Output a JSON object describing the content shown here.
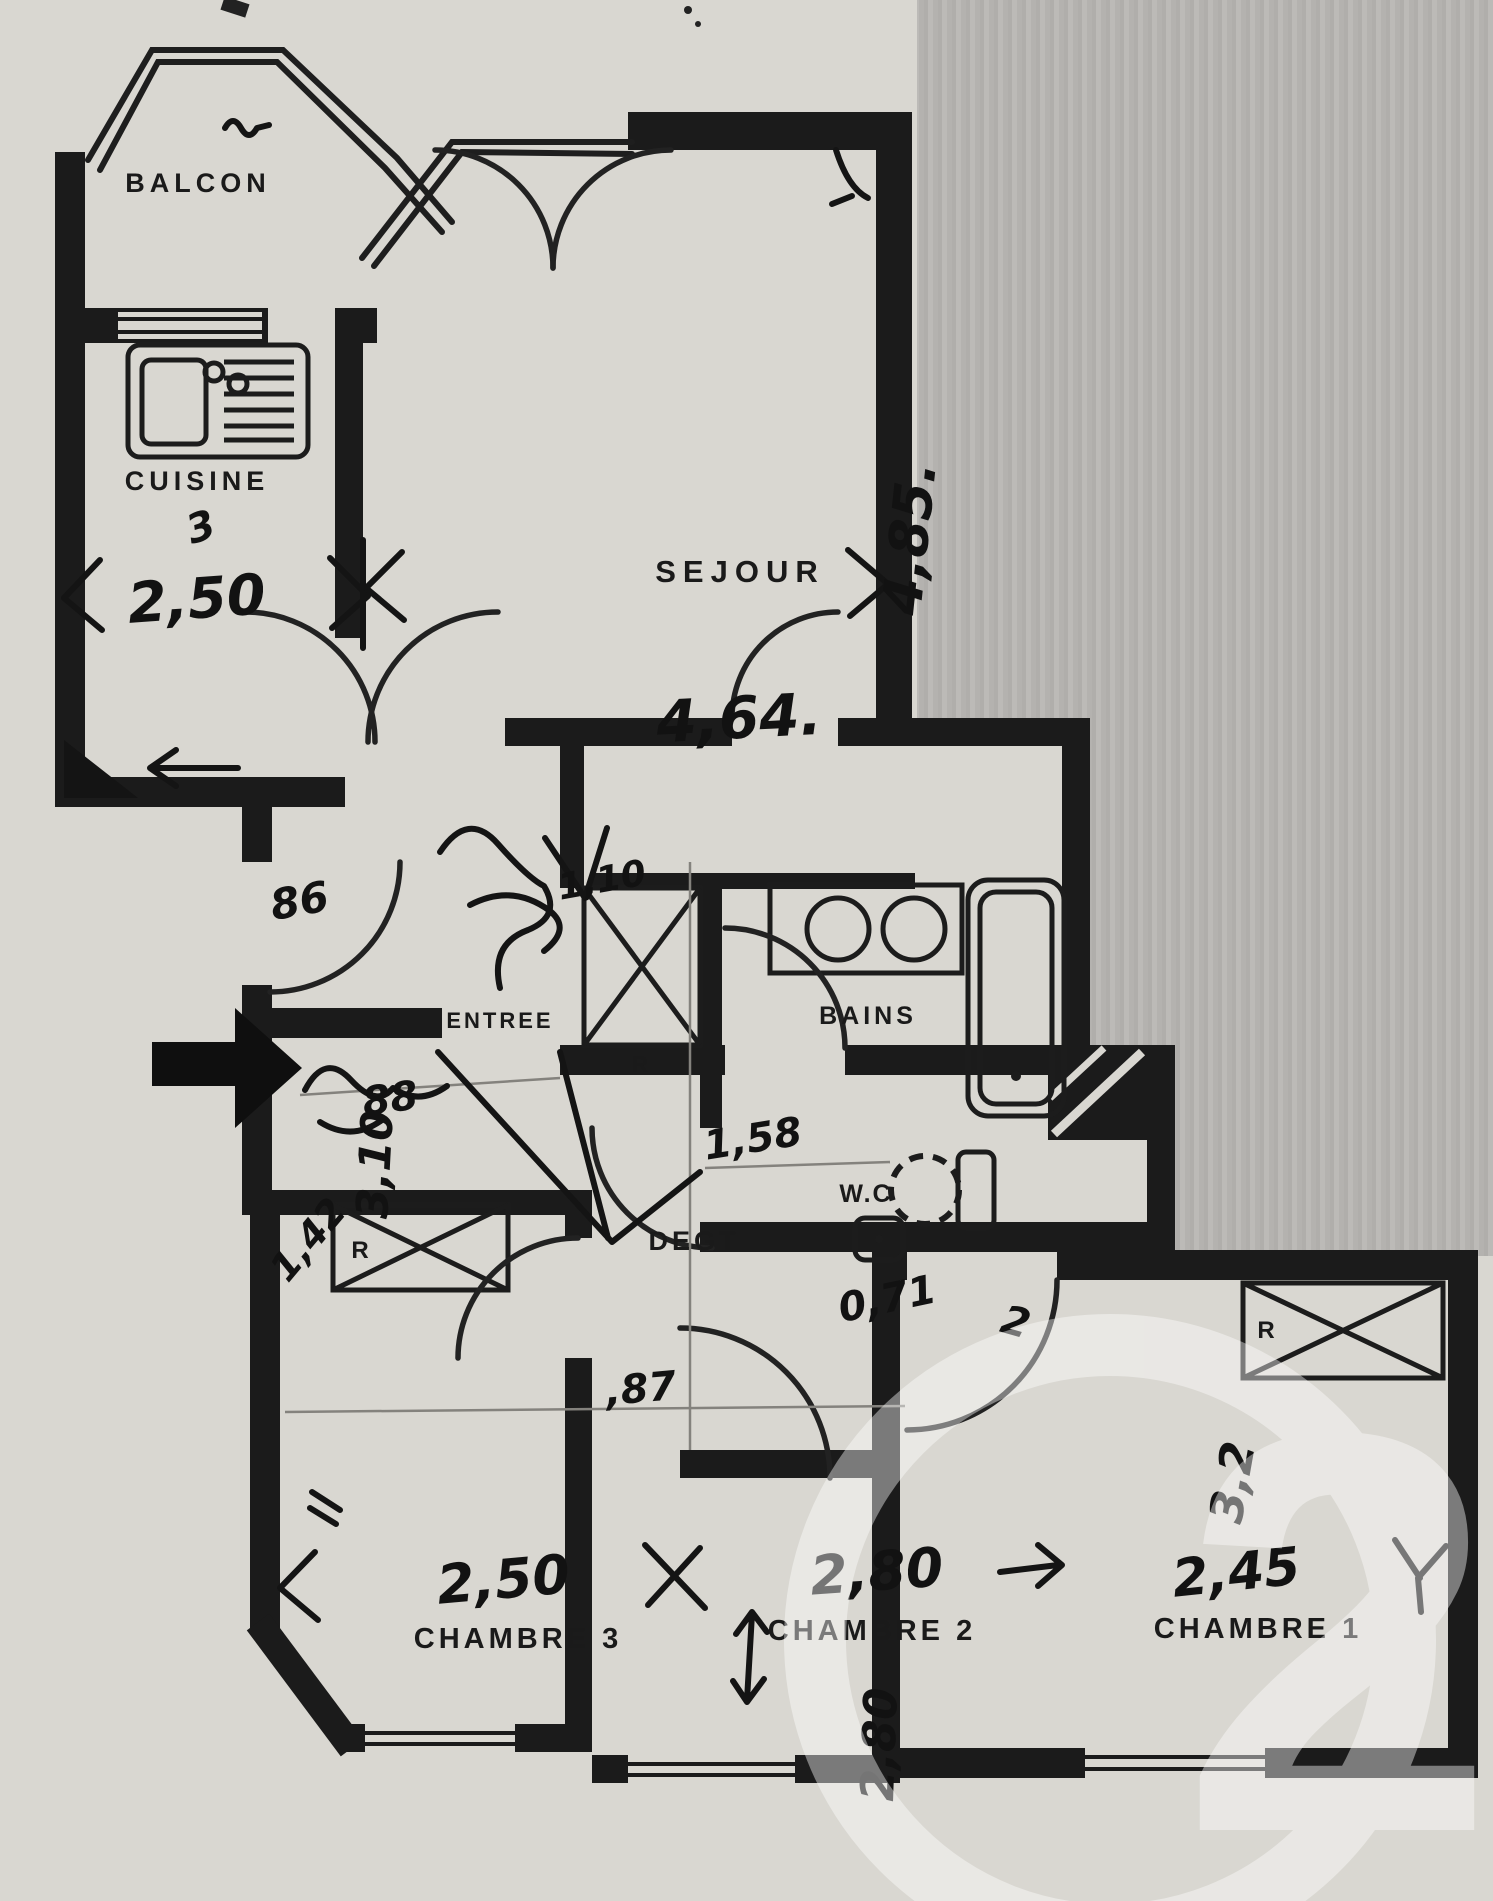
{
  "labels": {
    "balcon": "BALCON",
    "cuisine": "CUISINE",
    "sejour": "SEJOUR",
    "entree": "ENTREE",
    "bains": "BAINS",
    "wc": "W.C",
    "degt": "DEGT",
    "chambre3": "CHAMBRE 3",
    "chambre2": "CHAMBRE 2",
    "chambre1": "CHAMBRE 1",
    "closet": "R"
  },
  "dimensions": {
    "cuisine_width": "2,50",
    "sejour_width": "4,64.",
    "sejour_depth": "4,85.",
    "chambre3_width": "2,50",
    "chambre2_width": "2,80",
    "chambre2_depth": "2,80",
    "chambre1_width": "2,45",
    "chambre1_depth": "3,2",
    "degagement_depth": "3,10"
  },
  "annotations": {
    "near_entrance": "86",
    "entry_scribble": "88",
    "hall_width": "1,10",
    "wc_width_1": "1,58",
    "wc_width_2": "0,71",
    "degt_width": ",87",
    "misc_2": "2",
    "chambre3_note": "1,42",
    "cuisine_scribble": "3"
  },
  "watermark": {
    "brand": "Century 21",
    "text": "21"
  }
}
